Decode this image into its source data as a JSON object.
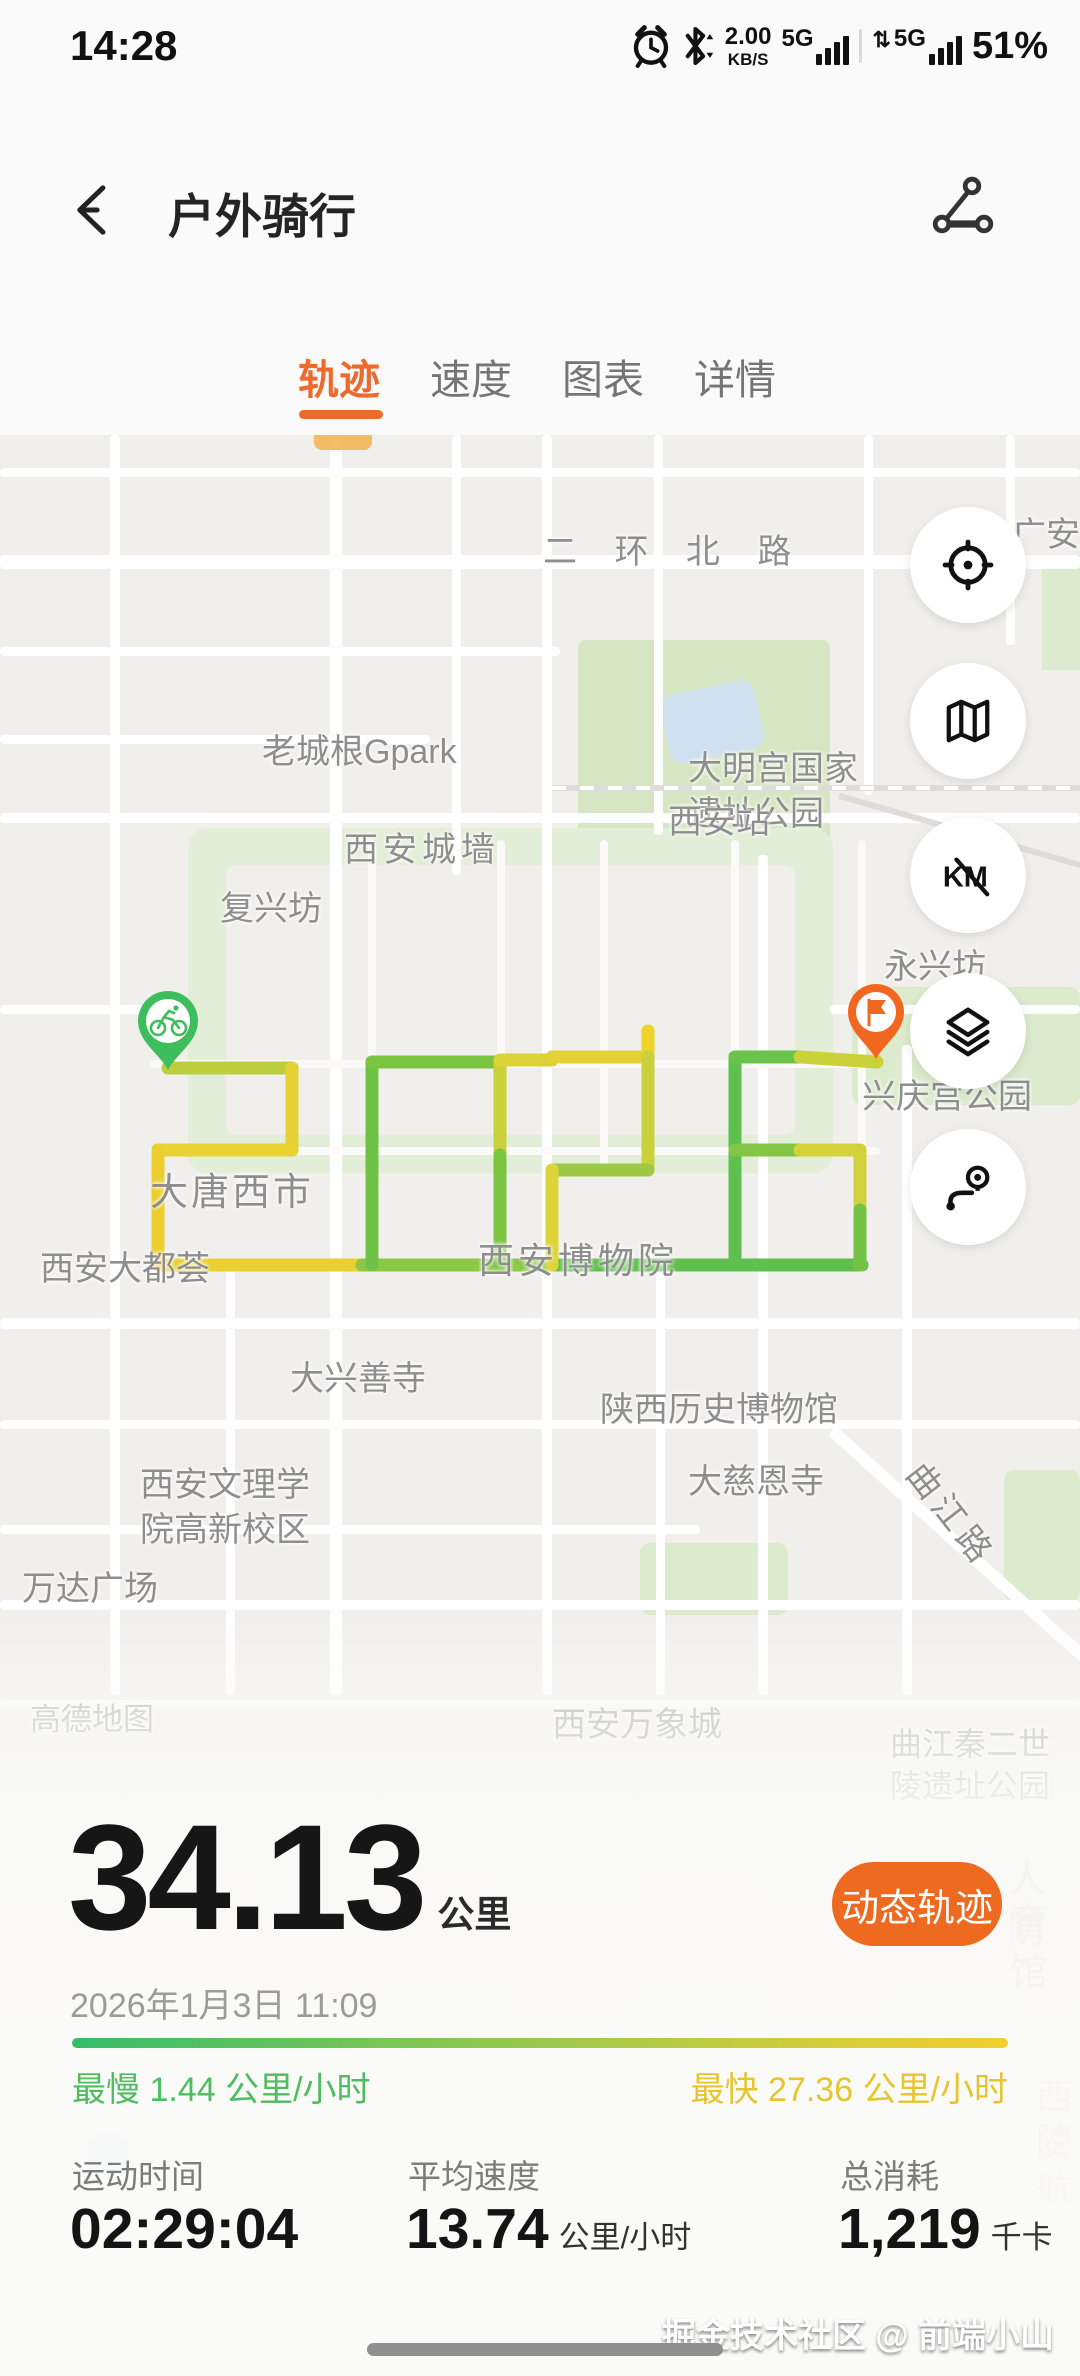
{
  "status_bar": {
    "time": "14:28",
    "net_speed": "2.00",
    "net_unit": "KB/S",
    "sim1": "5G",
    "sim2": "5G",
    "battery": "51%"
  },
  "header": {
    "title": "户外骑行"
  },
  "tabs": [
    {
      "label": "轨迹",
      "active": true
    },
    {
      "label": "速度",
      "active": false
    },
    {
      "label": "图表",
      "active": false
    },
    {
      "label": "详情",
      "active": false
    }
  ],
  "map": {
    "labels": [
      "二 环 北 路",
      "广安",
      "大明宫国家遗址公园",
      "老城根Gpark",
      "西安站",
      "西安城墙",
      "复兴坊",
      "永兴坊",
      "兴庆宫公园",
      "大唐西市",
      "西安大都荟",
      "西安博物院",
      "大兴善寺",
      "陕西历史博物馆",
      "大慈恩寺",
      "西安文理学院高新校区",
      "万达广场",
      "曲江路",
      "高德地图",
      "西安万象城",
      "曲江秦二世陵遗址公园",
      "人防",
      "育馆",
      "西安",
      "院航"
    ],
    "controls": [
      "locate",
      "map-mode",
      "km-scale",
      "layers",
      "route-preview"
    ],
    "markers": {
      "start": "bicycle-start-pin",
      "end": "flag-end-pin"
    }
  },
  "summary": {
    "distance": "34.13",
    "distance_unit": "公里",
    "dynamic_track_button": "动态轨迹",
    "datetime": "2026年1月3日 11:09",
    "slowest": "最慢 1.44 公里/小时",
    "fastest": "最快 27.36 公里/小时"
  },
  "metrics": [
    {
      "label": "运动时间",
      "value": "02:29:04",
      "unit": ""
    },
    {
      "label": "平均速度",
      "value": "13.74",
      "unit": "公里/小时"
    },
    {
      "label": "总消耗",
      "value": "1,219",
      "unit": "千卡"
    }
  ],
  "watermark": "掘金技术社区 @ 前端小山",
  "colors": {
    "accent_orange": "#ED6A2C",
    "button_orange": "#EE6A20",
    "route_yellow": "#E8D23A",
    "route_green": "#6EC344",
    "start_pin_green": "#3EBD5C",
    "end_pin_orange": "#F2671F",
    "grad_start_green": "#35BD6B",
    "grad_end_yellow": "#F2CE2E"
  }
}
